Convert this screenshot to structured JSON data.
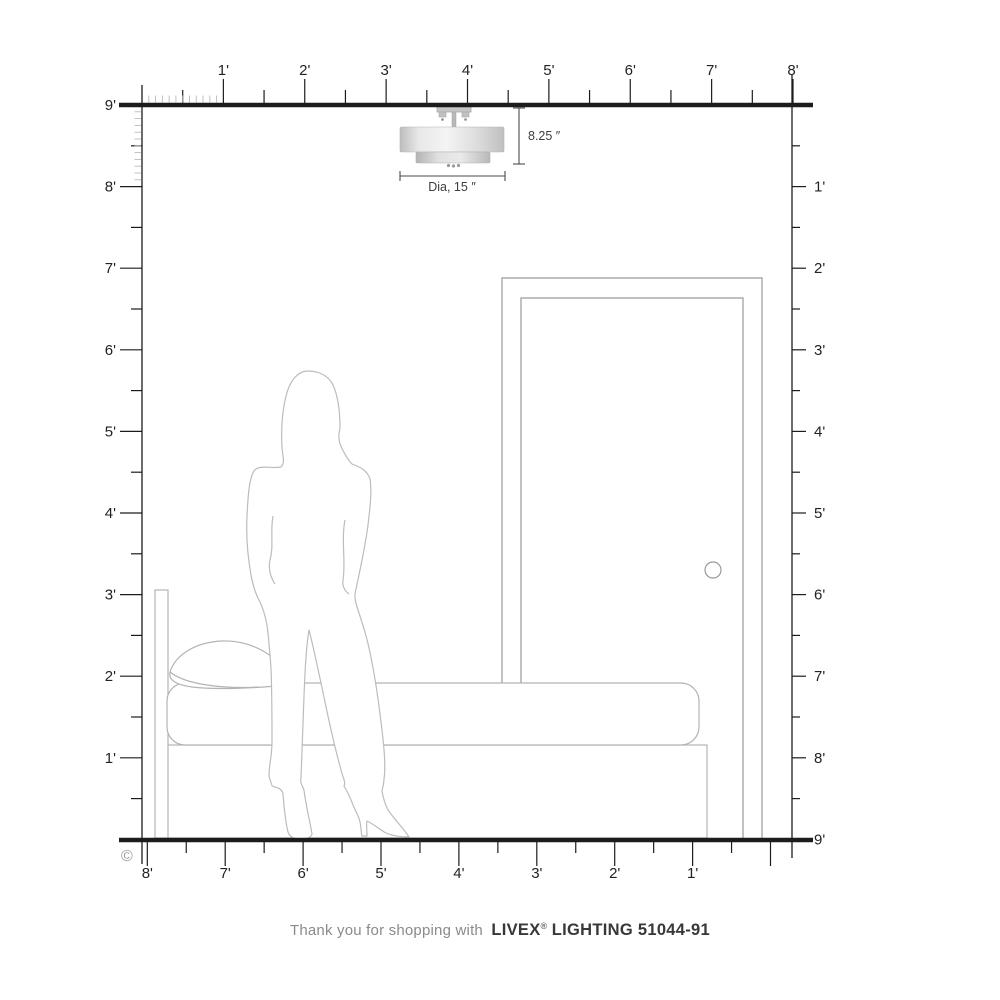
{
  "page": {
    "background": "#ffffff"
  },
  "rulers": {
    "top": {
      "labels": [
        "1'",
        "2'",
        "3'",
        "4'",
        "5'",
        "6'",
        "7'",
        "8'"
      ]
    },
    "left": {
      "labels": [
        "9'",
        "8'",
        "7'",
        "6'",
        "5'",
        "4'",
        "3'",
        "2'",
        "1'"
      ]
    },
    "right": {
      "labels": [
        "1'",
        "2'",
        "3'",
        "4'",
        "5'",
        "6'",
        "7'",
        "8'",
        "9'"
      ]
    },
    "bottom": {
      "labels": [
        "8'",
        "7'",
        "6'",
        "5'",
        "4'",
        "3'",
        "2'",
        "1'"
      ]
    }
  },
  "fixture": {
    "height_label": "8.25 ″",
    "diameter_label": "Dia, 15 ″"
  },
  "copyright_symbol": "©",
  "footer": {
    "prefix": "Thank you for shopping with",
    "brand": "LIVEX",
    "registered_mark": "®",
    "suffix": "LIGHTING 51044-91"
  },
  "colors": {
    "ruler_line": "#1c1c1c",
    "ruler_minor_tick": "#b9b9b9",
    "furniture_outline": "#b3b3b3",
    "person_outline": "#bcbcbc",
    "door_outline": "#9a9a9a",
    "dimension_line": "#4a4a4a",
    "shade_fill_light": "#f2f2f2",
    "shade_fill_dark": "#bdbdbd",
    "footer_text_gray": "#8a8a8a",
    "footer_text_dark": "#383838"
  }
}
